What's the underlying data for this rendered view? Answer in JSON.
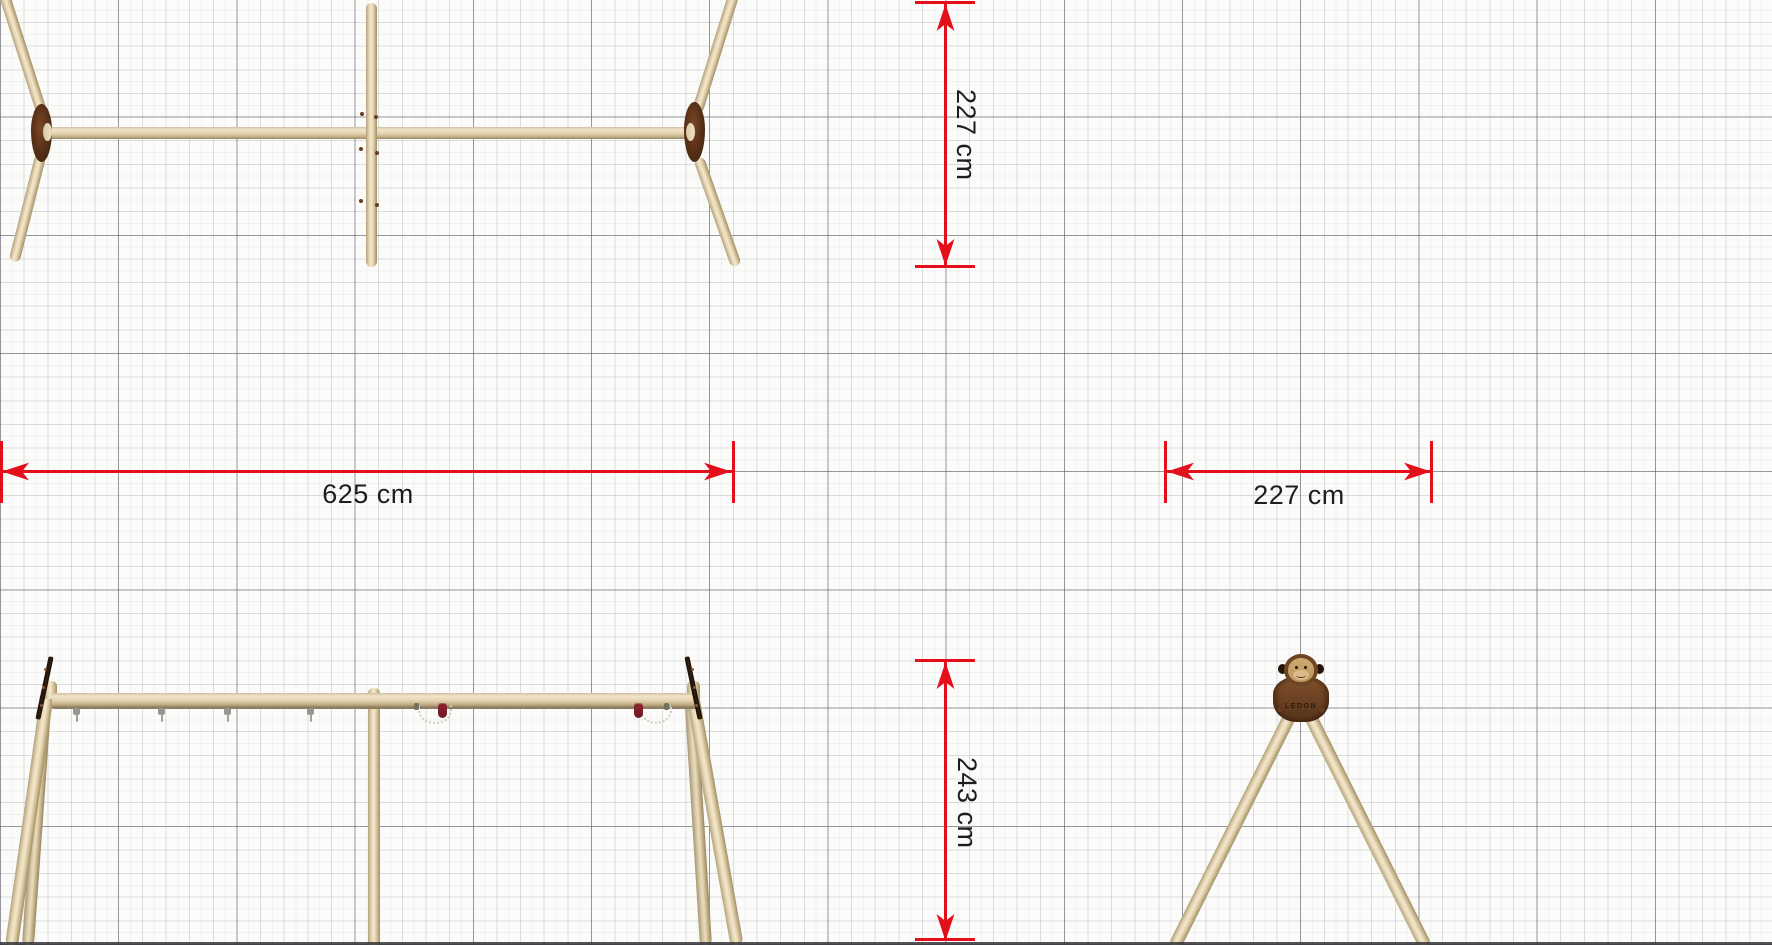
{
  "diagram": {
    "type": "product-dimension-drawing",
    "accent_color": "#e30f1a",
    "text_color": "#1d1d1b",
    "paper_color": "#fbfbfa",
    "grid": {
      "major_color": "#85858c",
      "major_spacing_px": 118.2,
      "minor_spacing_px": 23.64,
      "fine_spacing_px": 11.82
    },
    "dimensions": {
      "overall_width": {
        "label": "625 cm",
        "orientation": "horizontal"
      },
      "frame_depth_top": {
        "label": "227 cm",
        "orientation": "vertical"
      },
      "footprint_depth": {
        "label": "227 cm",
        "orientation": "horizontal"
      },
      "frame_height": {
        "label": "243 cm",
        "orientation": "vertical"
      }
    },
    "views": {
      "top_view": {
        "description": "swing frame from above"
      },
      "front_view": {
        "description": "swing frame from front",
        "hook_count": 4,
        "hanger_count": 2
      },
      "side_view": {
        "description": "A-frame from side",
        "logo_text": "LEDON"
      }
    },
    "colors": {
      "wood_light": "#f1e5c8",
      "wood_mid": "#ddcba6",
      "wood_dark": "#a18f68",
      "bracket_brown": "#5a3118",
      "hook_maroon": "#7c1f2a"
    }
  }
}
